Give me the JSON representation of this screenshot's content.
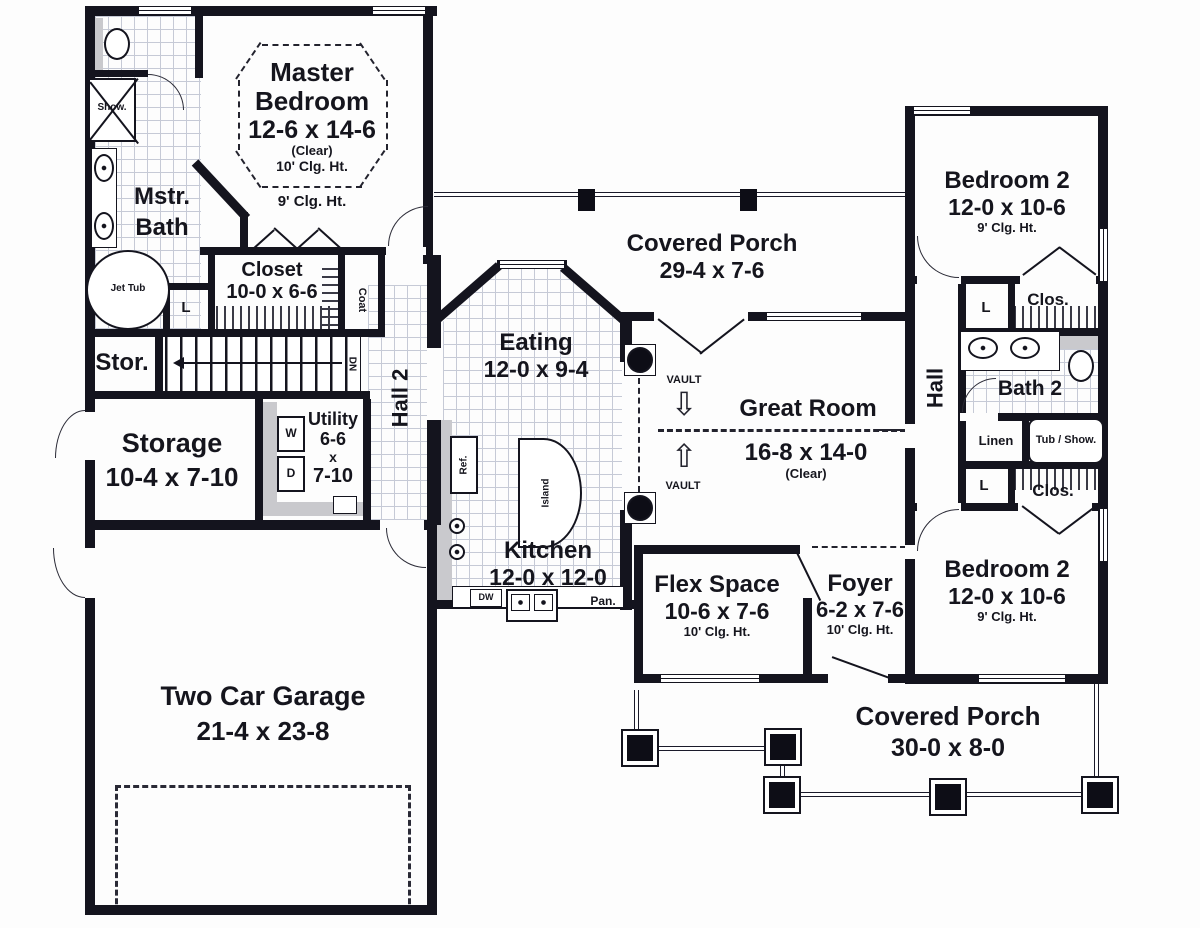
{
  "rooms": {
    "master_bedroom": {
      "name": "Master Bedroom",
      "dims": "12-6 x 14-6",
      "clear": "(Clear)",
      "ceiling": "10' Clg. Ht.",
      "ceiling_outer": "9' Clg. Ht."
    },
    "master_bath": {
      "name": "Mstr. Bath"
    },
    "master_closet": {
      "name": "Closet",
      "dims": "10-0 x 6-6"
    },
    "stor": {
      "name": "Stor."
    },
    "storage": {
      "name": "Storage",
      "dims": "10-4 x 7-10"
    },
    "utility": {
      "name": "Utility",
      "dim_w": "6-6",
      "by": "x",
      "dim_h": "7-10"
    },
    "hall2": {
      "name": "Hall 2"
    },
    "eating": {
      "name": "Eating",
      "dims": "12-0 x 9-4"
    },
    "kitchen": {
      "name": "Kitchen",
      "dims": "12-0 x 12-0"
    },
    "covered_porch_rear": {
      "name": "Covered Porch",
      "dims": "29-4 x 7-6"
    },
    "great_room": {
      "name": "Great Room",
      "dims": "16-8 x 14-0",
      "clear": "(Clear)"
    },
    "flex_space": {
      "name": "Flex Space",
      "dims": "10-6 x 7-6",
      "ceiling": "10' Clg. Ht."
    },
    "foyer": {
      "name": "Foyer",
      "dims": "6-2 x 7-6",
      "ceiling": "10' Clg. Ht."
    },
    "bedroom2_upper": {
      "name": "Bedroom 2",
      "dims": "12-0 x 10-6",
      "ceiling": "9' Clg. Ht."
    },
    "bedroom2_lower": {
      "name": "Bedroom 2",
      "dims": "12-0 x 10-6",
      "ceiling": "9' Clg. Ht."
    },
    "hall": {
      "name": "Hall"
    },
    "bath2": {
      "name": "Bath 2"
    },
    "garage": {
      "name": "Two Car Garage",
      "dims": "21-4 x 23-8"
    },
    "covered_porch_front": {
      "name": "Covered Porch",
      "dims": "30-0 x 8-0"
    }
  },
  "fixtures": {
    "shower": "Show.",
    "jet_tub": "Jet Tub",
    "coat": "Coat",
    "linen_abbr": "L",
    "washer": "W",
    "dryer": "D",
    "stairs_dn": "DN",
    "fridge": "Ref.",
    "island": "Island",
    "dishwasher": "DW",
    "pantry": "Pan.",
    "linen": "Linen",
    "tub_shower": "Tub / Show.",
    "closet_abbr": "Clos.",
    "vault": "VAULT"
  },
  "icons": {
    "vault_arrow_down": "⇩",
    "vault_arrow_up": "⇧"
  },
  "colors": {
    "wall": "#14141e",
    "tile_line": "#c6cad6",
    "gray": "#c9c9cd",
    "text": "#15151d"
  }
}
